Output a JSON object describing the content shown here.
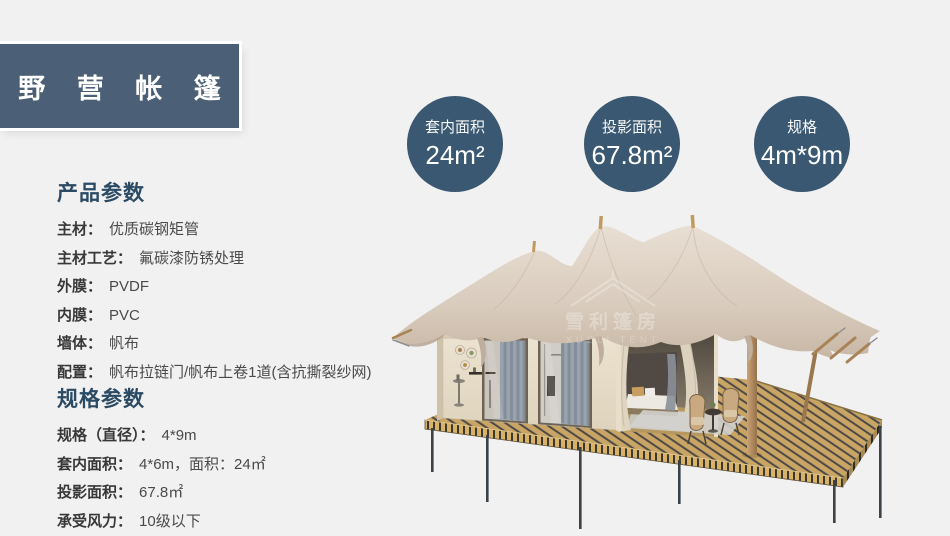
{
  "title": {
    "text": "野 营 帐 篷"
  },
  "badges": [
    {
      "label": "套内面积",
      "value": "24m²"
    },
    {
      "label": "投影面积",
      "value": "67.8m²"
    },
    {
      "label": "规格",
      "value": "4m*9m"
    }
  ],
  "product_params": {
    "heading": "产品参数",
    "rows": [
      {
        "label": "主材：",
        "value": "优质碳钢矩管"
      },
      {
        "label": "主材工艺：",
        "value": "氟碳漆防锈处理"
      },
      {
        "label": "外膜：",
        "value": "PVDF"
      },
      {
        "label": "内膜：",
        "value": "PVC"
      },
      {
        "label": "墙体：",
        "value": "帆布"
      },
      {
        "label": "配置：",
        "value": "帆布拉链门/帆布上卷1道(含抗撕裂纱网)"
      }
    ]
  },
  "spec_params": {
    "heading": "规格参数",
    "rows": [
      {
        "label": "规格（直径）：",
        "value": "4*9m"
      },
      {
        "label": "套内面积：",
        "value": "4*6m，面积：24㎡"
      },
      {
        "label": "投影面积：",
        "value": "67.8㎡"
      },
      {
        "label": "承受风力：",
        "value": "10级以下"
      }
    ]
  },
  "watermark": {
    "name": "雪利篷房",
    "name_en": "XUELI TENT"
  },
  "colors": {
    "page_bg": "#f1f1f2",
    "title_bg": "#4b6076",
    "badge_bg": "#3a5871",
    "heading": "#2b4a63",
    "label_text": "#383838",
    "value_text": "#4a4a4a",
    "canopy": "#d9cdc0",
    "deck_wood": "#c9a565"
  }
}
